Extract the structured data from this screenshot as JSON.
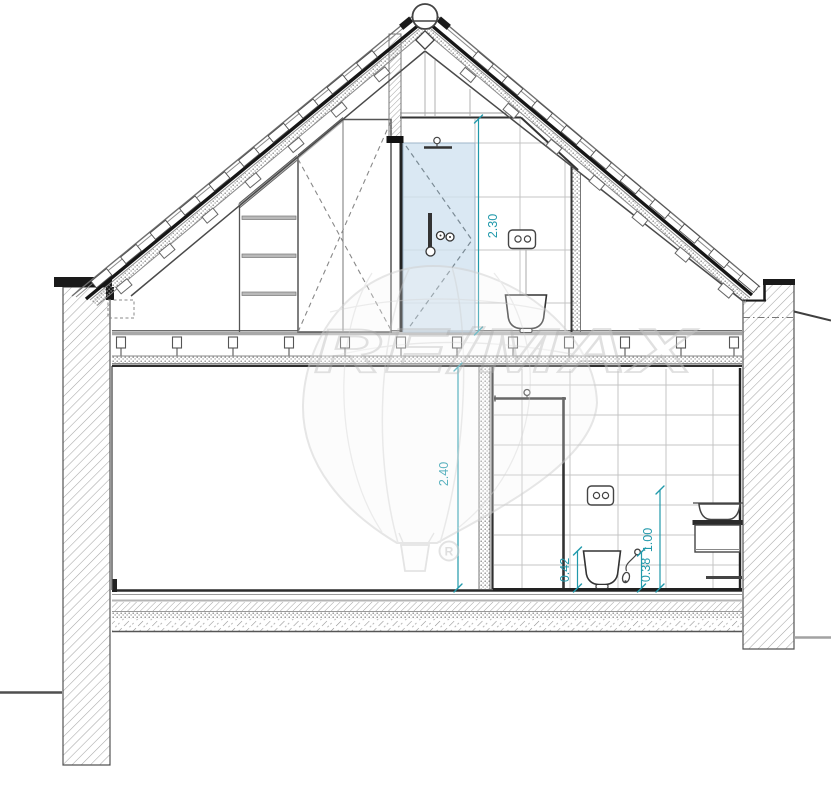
{
  "drawing": {
    "type": "building-cross-section",
    "dimensions": {
      "attic_room_height": "2.30",
      "ground_room_height": "2.40",
      "washbasin_height": "1.00",
      "toilet_height": "0.42",
      "hand_spray_height": "0.38"
    },
    "watermark": {
      "brand": "RE/MAX",
      "registered_mark": "R"
    },
    "colors": {
      "dimension_teal": "#2199ab",
      "shower_glass_blue": "#cfe1f0",
      "watermark_gray": "#d2d2d2",
      "line_dark": "#2d2d2d",
      "hatch_gray": "#a6a6a6"
    },
    "fixtures": [
      "attic-wardrobe",
      "attic-shelf-unit",
      "attic-shower",
      "attic-flush-plate",
      "attic-wall-hung-toilet",
      "ground-shower",
      "ground-flush-plate",
      "ground-wall-hung-toilet",
      "hand-spray",
      "washbasin-vanity",
      "towel-rail"
    ]
  }
}
